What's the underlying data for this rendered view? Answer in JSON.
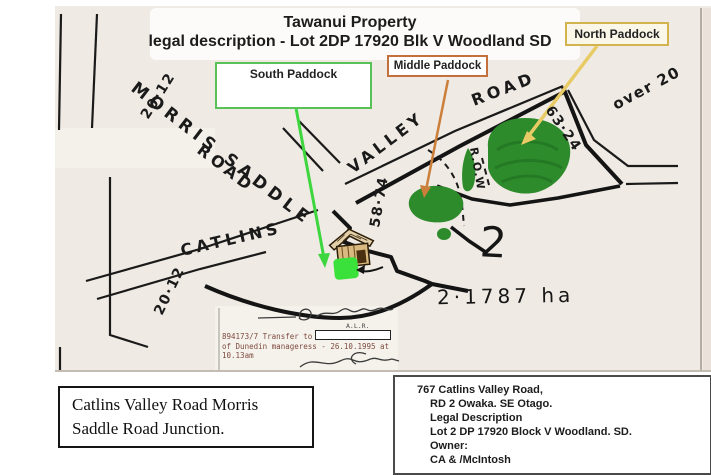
{
  "title": {
    "line1": "Tawanui Property",
    "line2": "legal description - Lot 2DP 17920 Blk V Woodland SD"
  },
  "paddock_labels": {
    "north": "North Paddock",
    "middle": "Middle Paddock",
    "south": "South Paddock"
  },
  "road_labels": {
    "morris_saddle": "MORRIS SADDLE",
    "morris_road": "ROAD",
    "catlins": "CATLINS",
    "valley": "VALLEY",
    "valley_road": "ROAD",
    "right_of_way": "R.O.W"
  },
  "measurements": {
    "morris_top": "20·12",
    "valley": "58·74",
    "north_east": "63·24",
    "over": "over 20",
    "catlins_bottom": "20·12"
  },
  "lot": {
    "number": "2",
    "area": "2·1787 ha"
  },
  "records": {
    "alr": "A.L.R.",
    "transfer_line1": "894173/7 Transfer to",
    "transfer_line2": "of Dunedin manageress - 26.10.1995 at",
    "transfer_line3": "10.13am"
  },
  "captions": {
    "junction": {
      "line1": "Catlins Valley Road Morris",
      "line2": "Saddle Road Junction."
    },
    "property": {
      "address_line1": "767  Catlins Valley Road,",
      "address_line2": "RD 2 Owaka.  SE Otago.",
      "legal_heading": "Legal Description",
      "legal_value": "Lot 2 DP 17920 Block V Woodland. SD.",
      "owner_heading": "Owner:",
      "owner_value": "CA & /McIntosh"
    }
  },
  "colors": {
    "paddock_green": "#2e8b2c",
    "south_marker_green": "#3be13b",
    "arrow_green": "#3ed63e",
    "arrow_orange": "#cc7f3a",
    "arrow_yellow": "#e9cb66",
    "north_box_border": "#d2b44e",
    "middle_box_border": "#c4703c",
    "south_box_border": "#58c158",
    "scan_background": "#efeae3",
    "records_text": "#7d4a3e"
  }
}
